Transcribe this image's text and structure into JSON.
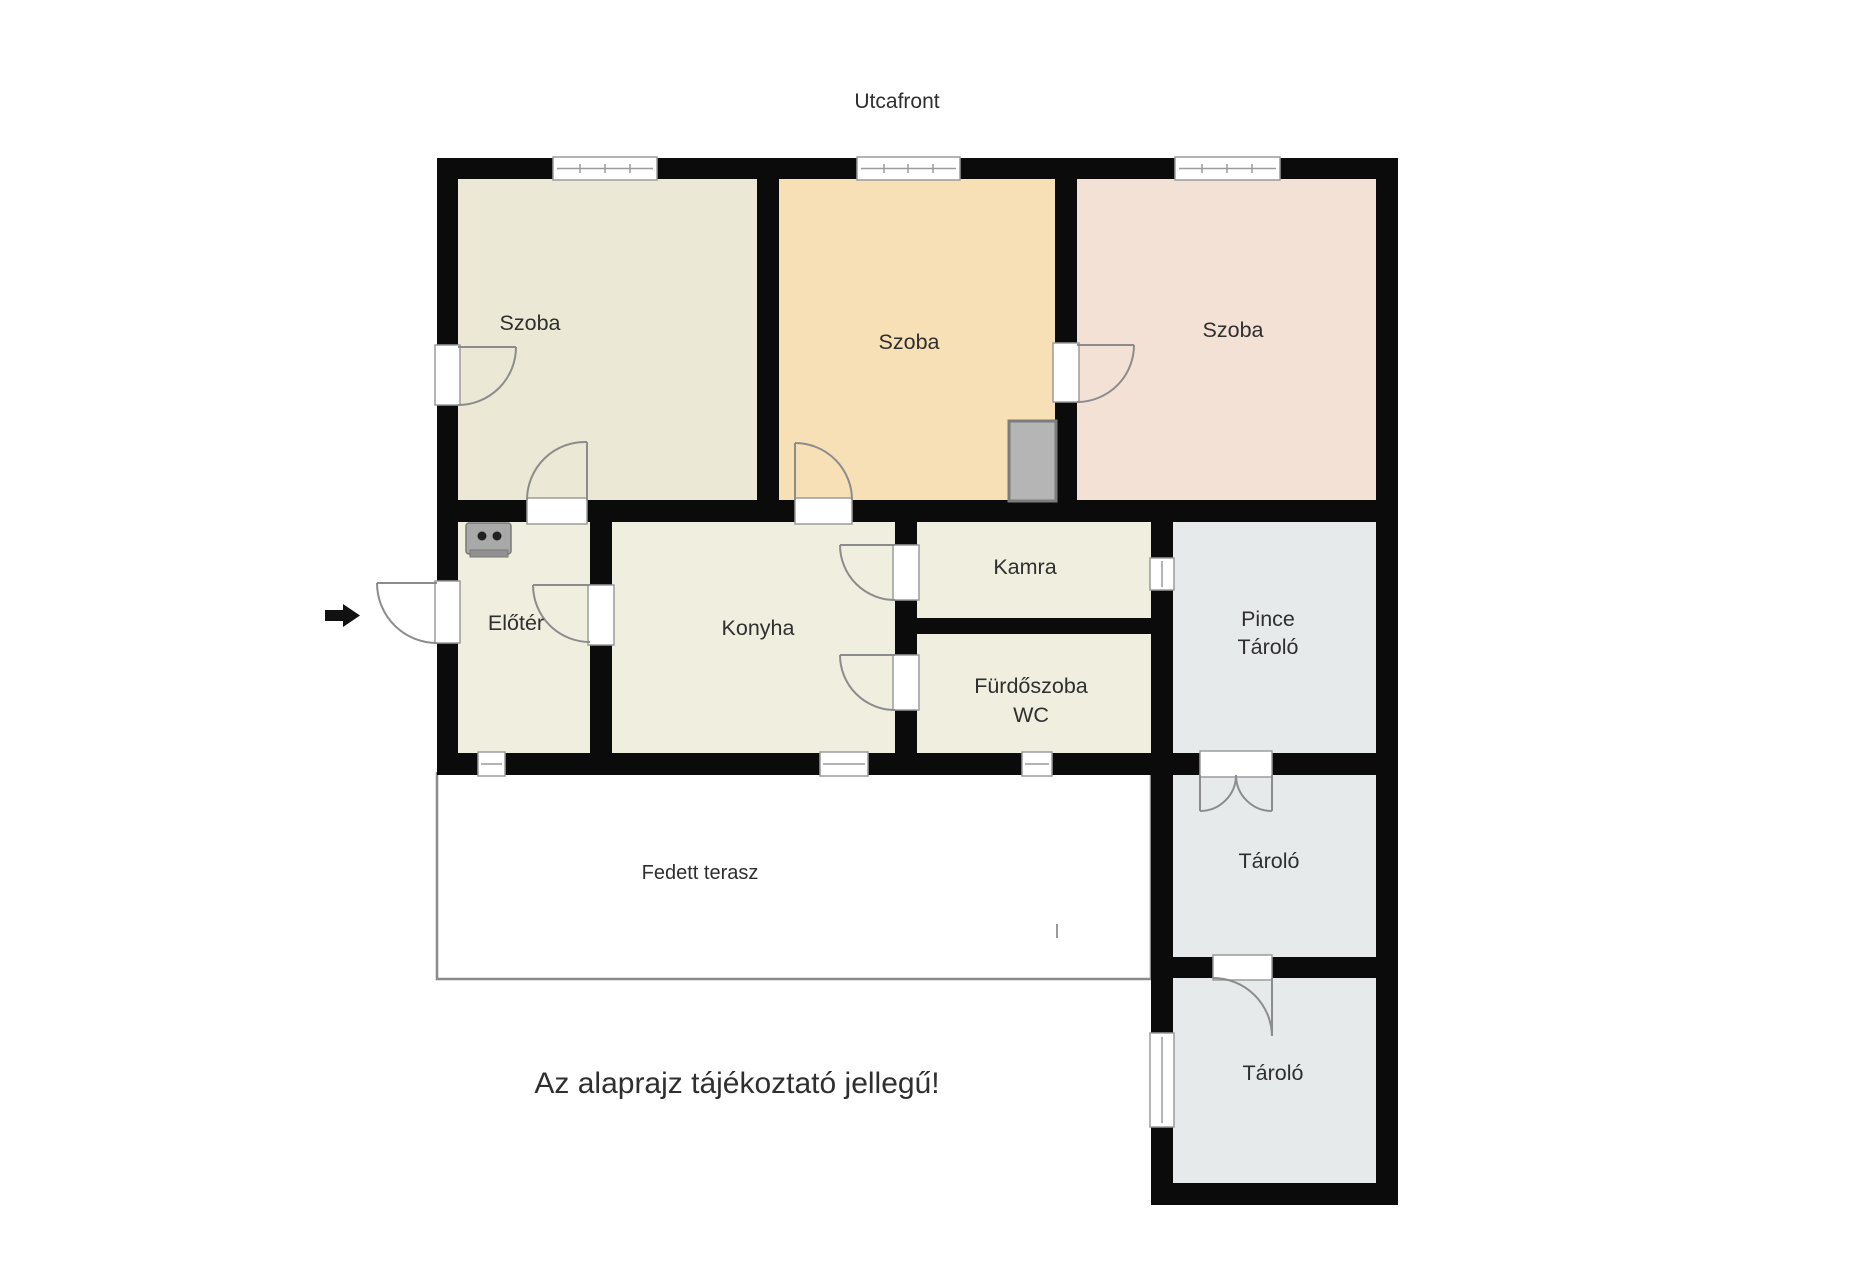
{
  "header": {
    "street_label": "Utcafront"
  },
  "note": "Az alaprajz tájékoztató jellegű!",
  "rooms": {
    "szoba1": {
      "label": "Szoba",
      "color": "#ebe8d5"
    },
    "szoba2": {
      "label": "Szoba",
      "color": "#f8e0b6"
    },
    "szoba3": {
      "label": "Szoba",
      "color": "#f3e1d5"
    },
    "eloter": {
      "label": "Előtér",
      "color": "#f0eede"
    },
    "konyha": {
      "label": "Konyha",
      "color": "#f0eede"
    },
    "kamra": {
      "label": "Kamra",
      "color": "#f0eede"
    },
    "furdoszoba": {
      "lines": [
        "Fürdőszoba",
        "WC"
      ],
      "color": "#f0eede"
    },
    "pince": {
      "lines": [
        "Pince",
        "Tároló"
      ],
      "color": "#e7eaea"
    },
    "tarolo_felso": {
      "label": "Tároló",
      "color": "#e7eaea"
    },
    "tarolo_also": {
      "label": "Tároló",
      "color": "#e7eaea"
    },
    "terasz": {
      "label": "Fedett terasz",
      "color": "#ffffff"
    }
  },
  "colors": {
    "wall": "#0b0b0b",
    "frame": "#9b9b9b",
    "arc": "#8c8c8c",
    "text": "#2f2f2f",
    "arrow": "#111111",
    "terrace_border": "#8a8a8a",
    "furniture_fill": "#b5b5b5",
    "furniture_stroke": "#7a7a7a",
    "stove_fill": "#a9a9a9",
    "stove_dot": "#222222"
  },
  "icons": {
    "entrance_arrow": "black right-pointing entrance arrow",
    "stove": "gray stove symbol with two burner dots",
    "furnace": "gray masonry heater block"
  }
}
